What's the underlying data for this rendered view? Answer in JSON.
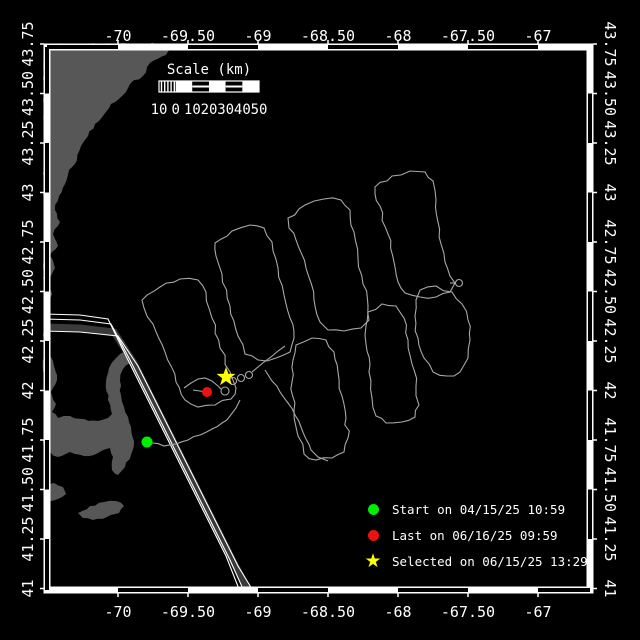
{
  "title": "Vehicle track map",
  "colors": {
    "background": "#000000",
    "frame": "#ffffff",
    "land": "#575757",
    "lane_band": "#3a3a3a",
    "lane_edge": "#ffffff",
    "track": "#a8a8a8",
    "text": "#ffffff",
    "start": "#00ee00",
    "last": "#ee1111",
    "selected": "#ffff00"
  },
  "axes": {
    "lon_labels": [
      "-70",
      "-69.50",
      "-69",
      "-68.50",
      "-68",
      "-67.50",
      "-67"
    ],
    "lat_labels": [
      "43.75",
      "43.50",
      "43.25",
      "43",
      "42.75",
      "42.50",
      "42.25",
      "42",
      "41.75",
      "41.50",
      "41.25",
      "41"
    ],
    "lon_x0": 118,
    "lon_dx": 70,
    "lat_y0": 44,
    "lat_dy": 49.5,
    "zebra_x": [
      47,
      118,
      188,
      258,
      328,
      398,
      468,
      538,
      590
    ],
    "zebra_y": [
      47,
      93.5,
      143,
      192.5,
      242,
      291.5,
      341,
      390.5,
      440,
      489.5,
      539,
      590
    ]
  },
  "frame": {
    "outer": 44,
    "inner": 50,
    "size": 549,
    "band": 6
  },
  "scalebar": {
    "title": "Scale (km)",
    "labels": [
      "10",
      "0",
      "10",
      "20",
      "30",
      "40",
      "50"
    ],
    "x": 159,
    "y": 81,
    "width": 100,
    "height": 11,
    "title_x": 209,
    "title_y": 74,
    "labels_y": 114
  },
  "legend": {
    "items": [
      {
        "marker": "circle",
        "color": "#00ee00",
        "label": "Start on 04/15/25 10:59"
      },
      {
        "marker": "circle",
        "color": "#ee1111",
        "label": "Last on 06/16/25 09:59"
      },
      {
        "marker": "star",
        "color": "#ffff00",
        "label": "Selected on 06/15/25 13:29"
      }
    ]
  },
  "markers": {
    "start": {
      "x": 147,
      "y": 442,
      "r": 5.5
    },
    "last": {
      "x": 207,
      "y": 392,
      "r": 5
    },
    "selected": {
      "x": 226,
      "y": 377,
      "r_outer": 10,
      "r_inner": 4
    }
  },
  "land_polygons": [
    [
      [
        44,
        44
      ],
      [
        172,
        44
      ],
      [
        166,
        55
      ],
      [
        150,
        63
      ],
      [
        143,
        76
      ],
      [
        130,
        84
      ],
      [
        122,
        96
      ],
      [
        111,
        104
      ],
      [
        103,
        116
      ],
      [
        95,
        124
      ],
      [
        88,
        136
      ],
      [
        81,
        146
      ],
      [
        77,
        160
      ],
      [
        69,
        170
      ],
      [
        65,
        184
      ],
      [
        59,
        196
      ],
      [
        55,
        210
      ],
      [
        60,
        222
      ],
      [
        53,
        234
      ],
      [
        58,
        246
      ],
      [
        50,
        256
      ],
      [
        55,
        268
      ],
      [
        48,
        280
      ],
      [
        52,
        294
      ],
      [
        46,
        308
      ],
      [
        50,
        320
      ],
      [
        44,
        328
      ]
    ],
    [
      [
        44,
        330
      ],
      [
        51,
        338
      ],
      [
        48,
        352
      ],
      [
        54,
        366
      ],
      [
        57,
        380
      ],
      [
        51,
        392
      ],
      [
        56,
        404
      ],
      [
        52,
        412
      ],
      [
        58,
        418
      ],
      [
        70,
        416
      ],
      [
        84,
        419
      ],
      [
        98,
        421
      ],
      [
        108,
        418
      ],
      [
        112,
        414
      ],
      [
        108,
        400
      ],
      [
        106,
        382
      ],
      [
        109,
        368
      ],
      [
        116,
        358
      ],
      [
        125,
        351
      ],
      [
        133,
        355
      ],
      [
        130,
        363
      ],
      [
        123,
        369
      ],
      [
        120,
        381
      ],
      [
        121,
        395
      ],
      [
        124,
        407
      ],
      [
        128,
        417
      ],
      [
        131,
        427
      ],
      [
        134,
        441
      ],
      [
        131,
        455
      ],
      [
        125,
        467
      ],
      [
        118,
        475
      ],
      [
        112,
        470
      ],
      [
        113,
        457
      ],
      [
        110,
        448
      ],
      [
        98,
        453
      ],
      [
        84,
        456
      ],
      [
        70,
        452
      ],
      [
        58,
        457
      ],
      [
        50,
        452
      ],
      [
        44,
        447
      ]
    ],
    [
      [
        44,
        486
      ],
      [
        54,
        483
      ],
      [
        63,
        487
      ],
      [
        66,
        494
      ],
      [
        58,
        499
      ],
      [
        47,
        501
      ],
      [
        44,
        497
      ]
    ],
    [
      [
        78,
        513
      ],
      [
        90,
        506
      ],
      [
        104,
        502
      ],
      [
        116,
        501
      ],
      [
        124,
        506
      ],
      [
        119,
        513
      ],
      [
        107,
        517
      ],
      [
        93,
        520
      ],
      [
        83,
        518
      ]
    ]
  ],
  "lane": {
    "band_width": 7,
    "band": [
      [
        44,
        327
      ],
      [
        80,
        328
      ],
      [
        114,
        332
      ],
      [
        134,
        363
      ],
      [
        154,
        403
      ],
      [
        174,
        443
      ],
      [
        194,
        483
      ],
      [
        214,
        523
      ],
      [
        234,
        563
      ],
      [
        248,
        589
      ]
    ],
    "edges": [
      [
        [
          44,
          314
        ],
        [
          80,
          315
        ],
        [
          108,
          319
        ],
        [
          126,
          356
        ],
        [
          146,
          396
        ],
        [
          166,
          436
        ],
        [
          186,
          476
        ],
        [
          206,
          516
        ],
        [
          226,
          556
        ],
        [
          239,
          589
        ]
      ],
      [
        [
          44,
          319
        ],
        [
          80,
          320
        ],
        [
          111,
          324
        ],
        [
          130,
          360
        ],
        [
          150,
          400
        ],
        [
          170,
          440
        ],
        [
          190,
          480
        ],
        [
          210,
          520
        ],
        [
          230,
          560
        ],
        [
          243,
          589
        ]
      ],
      [
        [
          44,
          331
        ],
        [
          80,
          332
        ],
        [
          118,
          336
        ],
        [
          138,
          366
        ],
        [
          158,
          406
        ],
        [
          178,
          446
        ],
        [
          198,
          486
        ],
        [
          218,
          526
        ],
        [
          238,
          566
        ],
        [
          252,
          589
        ]
      ]
    ]
  },
  "track": {
    "loops": [
      [
        [
          142,
          300
        ],
        [
          160,
          287
        ],
        [
          180,
          279
        ],
        [
          198,
          280
        ],
        [
          206,
          292
        ],
        [
          212,
          318
        ],
        [
          220,
          348
        ],
        [
          230,
          372
        ],
        [
          236,
          388
        ],
        [
          231,
          399
        ],
        [
          215,
          405
        ],
        [
          198,
          407
        ],
        [
          185,
          400
        ],
        [
          176,
          382
        ],
        [
          165,
          352
        ],
        [
          153,
          324
        ],
        [
          144,
          308
        ]
      ],
      [
        [
          215,
          243
        ],
        [
          232,
          231
        ],
        [
          250,
          225
        ],
        [
          264,
          228
        ],
        [
          272,
          242
        ],
        [
          278,
          268
        ],
        [
          284,
          295
        ],
        [
          290,
          318
        ],
        [
          294,
          338
        ],
        [
          290,
          352
        ],
        [
          276,
          358
        ],
        [
          258,
          360
        ],
        [
          245,
          354
        ],
        [
          238,
          336
        ],
        [
          230,
          306
        ],
        [
          222,
          274
        ],
        [
          216,
          256
        ]
      ],
      [
        [
          288,
          218
        ],
        [
          305,
          205
        ],
        [
          324,
          199
        ],
        [
          341,
          200
        ],
        [
          350,
          210
        ],
        [
          354,
          232
        ],
        [
          358,
          258
        ],
        [
          363,
          284
        ],
        [
          368,
          306
        ],
        [
          369,
          320
        ],
        [
          361,
          328
        ],
        [
          344,
          331
        ],
        [
          328,
          330
        ],
        [
          320,
          322
        ],
        [
          314,
          300
        ],
        [
          306,
          268
        ],
        [
          296,
          240
        ],
        [
          289,
          228
        ]
      ],
      [
        [
          375,
          187
        ],
        [
          392,
          176
        ],
        [
          410,
          171
        ],
        [
          425,
          172
        ],
        [
          433,
          181
        ],
        [
          436,
          200
        ],
        [
          438,
          222
        ],
        [
          441,
          244
        ],
        [
          445,
          262
        ],
        [
          450,
          276
        ],
        [
          455,
          283
        ],
        [
          450,
          292
        ],
        [
          436,
          297
        ],
        [
          420,
          297
        ],
        [
          405,
          293
        ],
        [
          398,
          282
        ],
        [
          394,
          262
        ],
        [
          388,
          234
        ],
        [
          380,
          206
        ],
        [
          375,
          194
        ]
      ],
      [
        [
          296,
          345
        ],
        [
          312,
          338
        ],
        [
          326,
          340
        ],
        [
          334,
          352
        ],
        [
          338,
          372
        ],
        [
          342,
          396
        ],
        [
          346,
          418
        ],
        [
          348,
          438
        ],
        [
          344,
          452
        ],
        [
          332,
          458
        ],
        [
          316,
          460
        ],
        [
          304,
          454
        ],
        [
          298,
          436
        ],
        [
          294,
          410
        ],
        [
          292,
          382
        ],
        [
          293,
          360
        ]
      ],
      [
        [
          368,
          312
        ],
        [
          382,
          304
        ],
        [
          396,
          306
        ],
        [
          404,
          318
        ],
        [
          408,
          340
        ],
        [
          412,
          364
        ],
        [
          416,
          386
        ],
        [
          419,
          405
        ],
        [
          415,
          417
        ],
        [
          402,
          422
        ],
        [
          386,
          423
        ],
        [
          376,
          416
        ],
        [
          372,
          398
        ],
        [
          369,
          372
        ],
        [
          366,
          344
        ],
        [
          366,
          326
        ]
      ],
      [
        [
          420,
          290
        ],
        [
          436,
          286
        ],
        [
          452,
          292
        ],
        [
          462,
          304
        ],
        [
          468,
          320
        ],
        [
          470,
          340
        ],
        [
          468,
          358
        ],
        [
          460,
          372
        ],
        [
          447,
          376
        ],
        [
          433,
          372
        ],
        [
          424,
          358
        ],
        [
          418,
          338
        ],
        [
          415,
          316
        ],
        [
          416,
          300
        ]
      ]
    ],
    "lines": [
      [
        [
          152,
          443
        ],
        [
          164,
          446
        ],
        [
          176,
          444
        ],
        [
          188,
          440
        ],
        [
          200,
          435
        ],
        [
          212,
          429
        ],
        [
          222,
          423
        ],
        [
          230,
          416
        ],
        [
          236,
          408
        ],
        [
          240,
          400
        ]
      ],
      [
        [
          184,
          388
        ],
        [
          191,
          383
        ],
        [
          198,
          379
        ],
        [
          205,
          378
        ],
        [
          212,
          381
        ],
        [
          218,
          386
        ],
        [
          221,
          389
        ]
      ],
      [
        [
          252,
          372
        ],
        [
          258,
          367
        ],
        [
          264,
          362
        ],
        [
          271,
          357
        ],
        [
          278,
          351
        ],
        [
          285,
          346
        ]
      ],
      [
        [
          193,
          390
        ],
        [
          200,
          391
        ],
        [
          206,
          392
        ]
      ],
      [
        [
          265,
          370
        ],
        [
          272,
          381
        ],
        [
          280,
          392
        ],
        [
          288,
          403
        ],
        [
          295,
          415
        ],
        [
          301,
          427
        ],
        [
          306,
          439
        ],
        [
          311,
          450
        ],
        [
          318,
          457
        ],
        [
          328,
          461
        ]
      ],
      [
        [
          450,
          283
        ],
        [
          456,
          283
        ]
      ]
    ],
    "circles": [
      [
        225,
        391,
        4
      ],
      [
        233,
        381,
        3.5
      ],
      [
        241,
        378,
        3.5
      ],
      [
        249,
        375,
        3.5
      ],
      [
        459,
        283,
        3.5
      ]
    ]
  }
}
